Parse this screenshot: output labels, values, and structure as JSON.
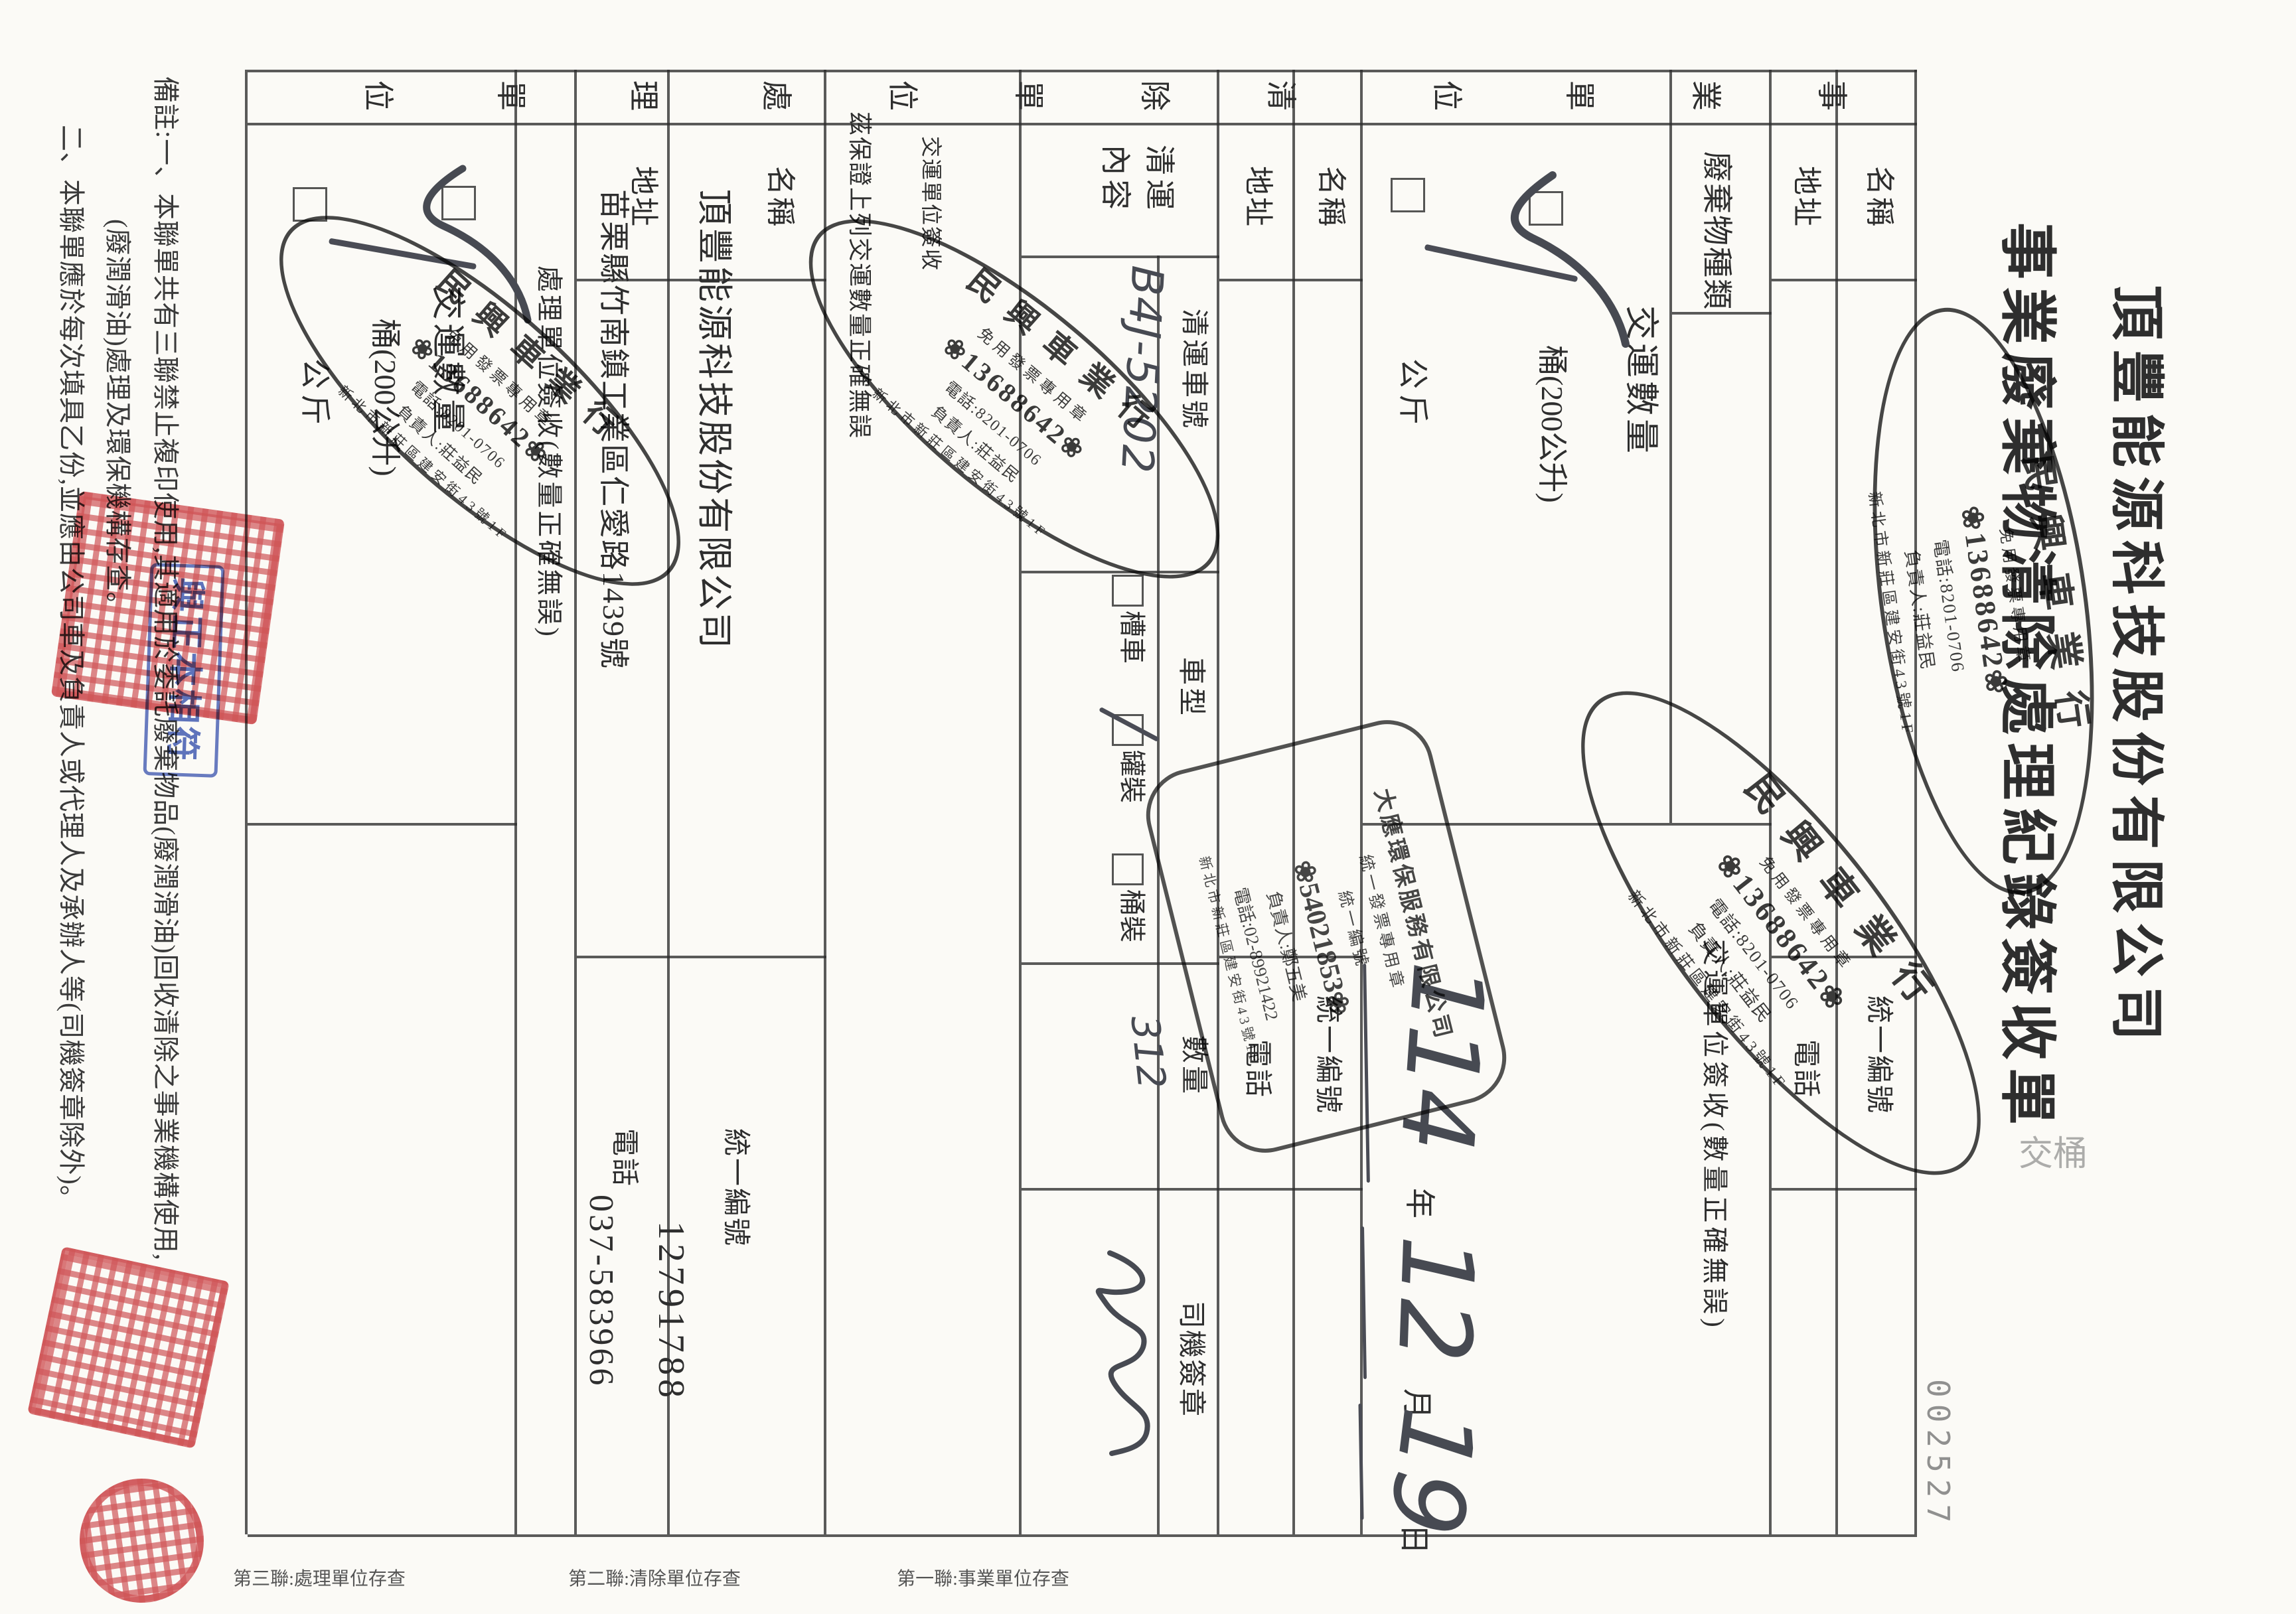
{
  "serial": "002527",
  "title": {
    "company": "頂豐能源科技股份有限公司",
    "form_name": "事業廢棄物清除處理紀錄簽收單"
  },
  "stray_marks": "交桶",
  "generator": {
    "tab": [
      "事",
      "業",
      "單",
      "位"
    ],
    "name_label": "名稱",
    "addr_label": "地址",
    "ubn_label": "統一編號",
    "tel_label": "電話",
    "waste_type_label": "廢棄物種類",
    "qty_label": "交運數量",
    "unit_barrel": "桶(200公升)",
    "unit_kg": "公斤",
    "signoff_line": "交運單位簽收(數量正確無誤)",
    "date": {
      "y_hand": "114",
      "y": "年",
      "m_hand": "12",
      "m": "月",
      "d_hand": "19",
      "d": "日"
    }
  },
  "transporter": {
    "tab": [
      "清",
      "除",
      "單",
      "位"
    ],
    "name_label": "名稱",
    "addr_label": "地址",
    "ubn_label": "統一編號",
    "tel_label": "電話",
    "content_label_1": "清運",
    "content_label_2": "內容",
    "vehicle_no_label": "清運車號",
    "vehicle_no_hand": "B4J-5202",
    "vehicle_type_label": "車型",
    "type_options": [
      "槽車",
      "罐裝",
      "桶裝"
    ],
    "qty_label": "數量",
    "qty_hand": "312",
    "driver_label": "司機簽章",
    "signoff_title": "交運單位簽收",
    "guarantee": "茲保證上列交運數量正確無誤"
  },
  "processor": {
    "tab": [
      "處",
      "理",
      "單",
      "位"
    ],
    "name_label": "名稱",
    "name_value": "頂豐能源科技股份有限公司",
    "addr_label": "地址",
    "addr_value": "苗栗縣竹南鎮工業區仁愛路1439號",
    "ubn_label": "統一編號",
    "ubn_value": "12791788",
    "tel_label": "電話",
    "tel_value": "037-583966",
    "signoff_line": "處理單位簽收(數量正確無誤)",
    "qty_label": "交運數量",
    "unit_barrel": "桶(200公升)",
    "unit_kg": "公斤"
  },
  "stamps": {
    "minxing": {
      "name": "民興車業行",
      "tax": "免用發票專用章",
      "ubn_label": "統一編號",
      "ubn": "❀13688642❀",
      "tel": "電話:8201-0706",
      "owner": "負責人:莊益民",
      "addr": "新北市新莊區建安街43號1F"
    },
    "dayin": {
      "name": "大應環保服務有限公司",
      "tax": "統一發票專用章",
      "ubn_label": "統一編號",
      "ubn": "❀54021853❀",
      "owner": "負責人:鄭五美",
      "tel": "電話:02-89921422",
      "addr": "新北市新莊區建安街43號1F"
    },
    "blue_text": "與正本相符"
  },
  "notes": {
    "l1": "備註:一、本聯單共有三聯禁止複印使用,其適用於委託廢棄物品(廢潤滑油)回收清除之事業機構使用,",
    "l2": "(廢潤滑油)處理及環保機構存查。",
    "l3": "二、本聯單應於每次填具乙份,並應由公司車及負責人或代理人及承辦人等(司機簽章除外)。"
  },
  "sidebar": [
    "第一聯:事業單位存查",
    "第二聯:清除單位存查",
    "第三聯:處理單位存查"
  ]
}
